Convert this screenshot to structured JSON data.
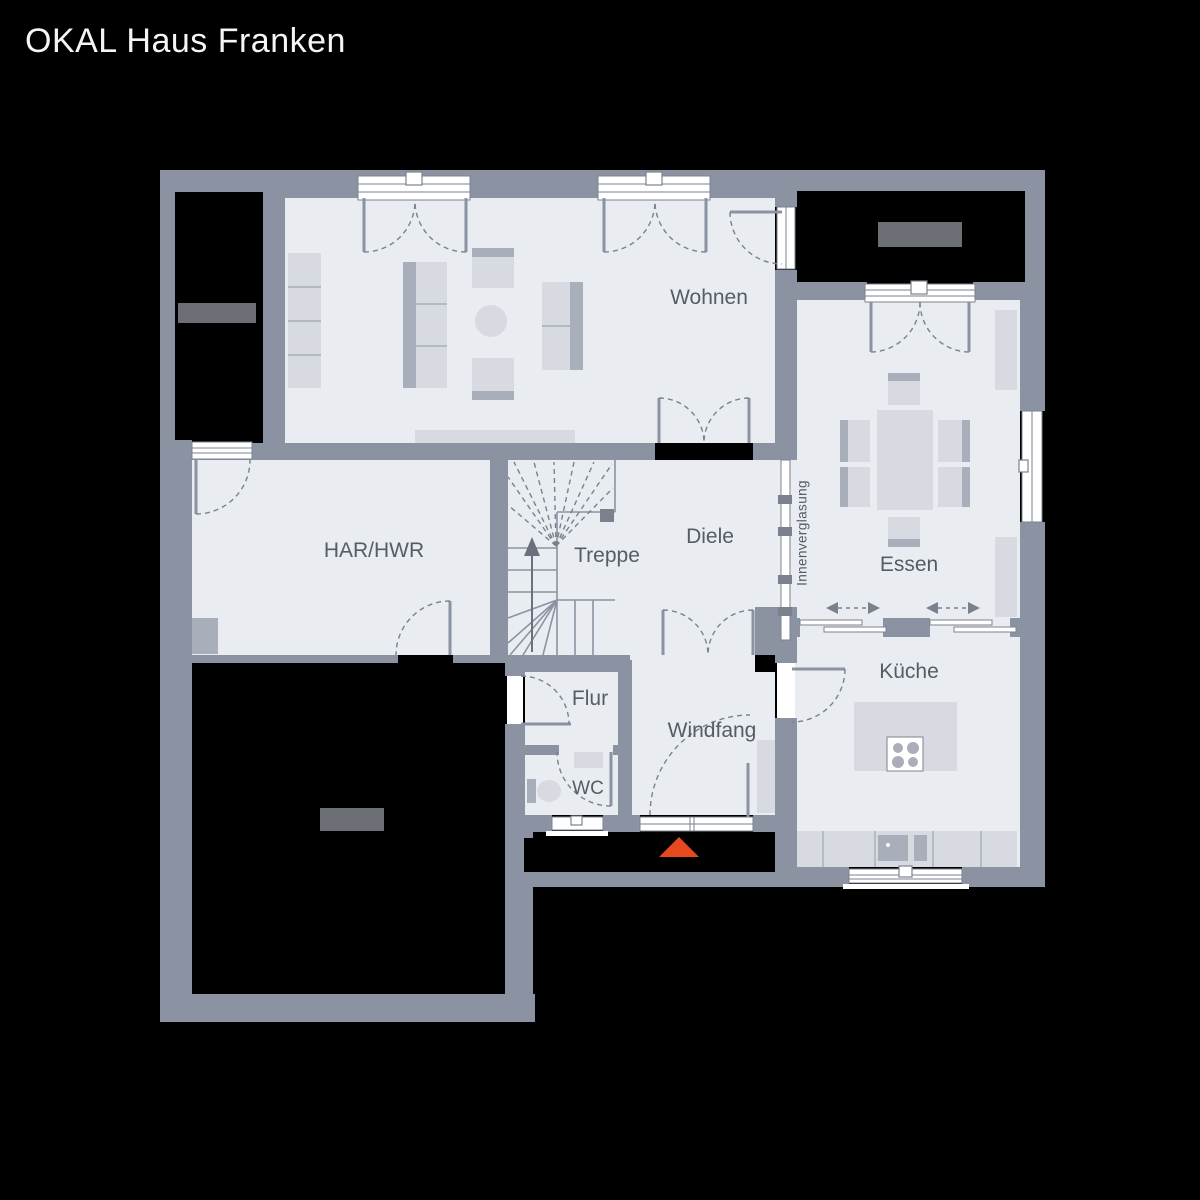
{
  "title": "OKAL Haus Franken",
  "rooms": {
    "wohnen": {
      "label": "Wohnen"
    },
    "har_hwr": {
      "label": "HAR/HWR"
    },
    "treppe": {
      "label": "Treppe"
    },
    "diele": {
      "label": "Diele"
    },
    "essen": {
      "label": "Essen"
    },
    "kueche": {
      "label": "Küche"
    },
    "flur": {
      "label": "Flur"
    },
    "wc": {
      "label": "WC"
    },
    "windfang": {
      "label": "Windfang"
    }
  },
  "annotations": {
    "glazing": "Innenverglasung"
  },
  "markers": {
    "entrance_marker": "entrance-triangle"
  },
  "colors": {
    "bg": "#000000",
    "wall": "#8b93a2",
    "wall_dark": "#7b828e",
    "floor": "#e9ecf1",
    "furn_light": "#d7dae1",
    "furn_mid": "#a9afba",
    "white": "#ffffff",
    "dash": "#7a818d",
    "accent": "#e5491d",
    "redact": "#000000",
    "redact_label": "#6b6e74",
    "label": "#565b66",
    "title": "#f5f5f5"
  }
}
